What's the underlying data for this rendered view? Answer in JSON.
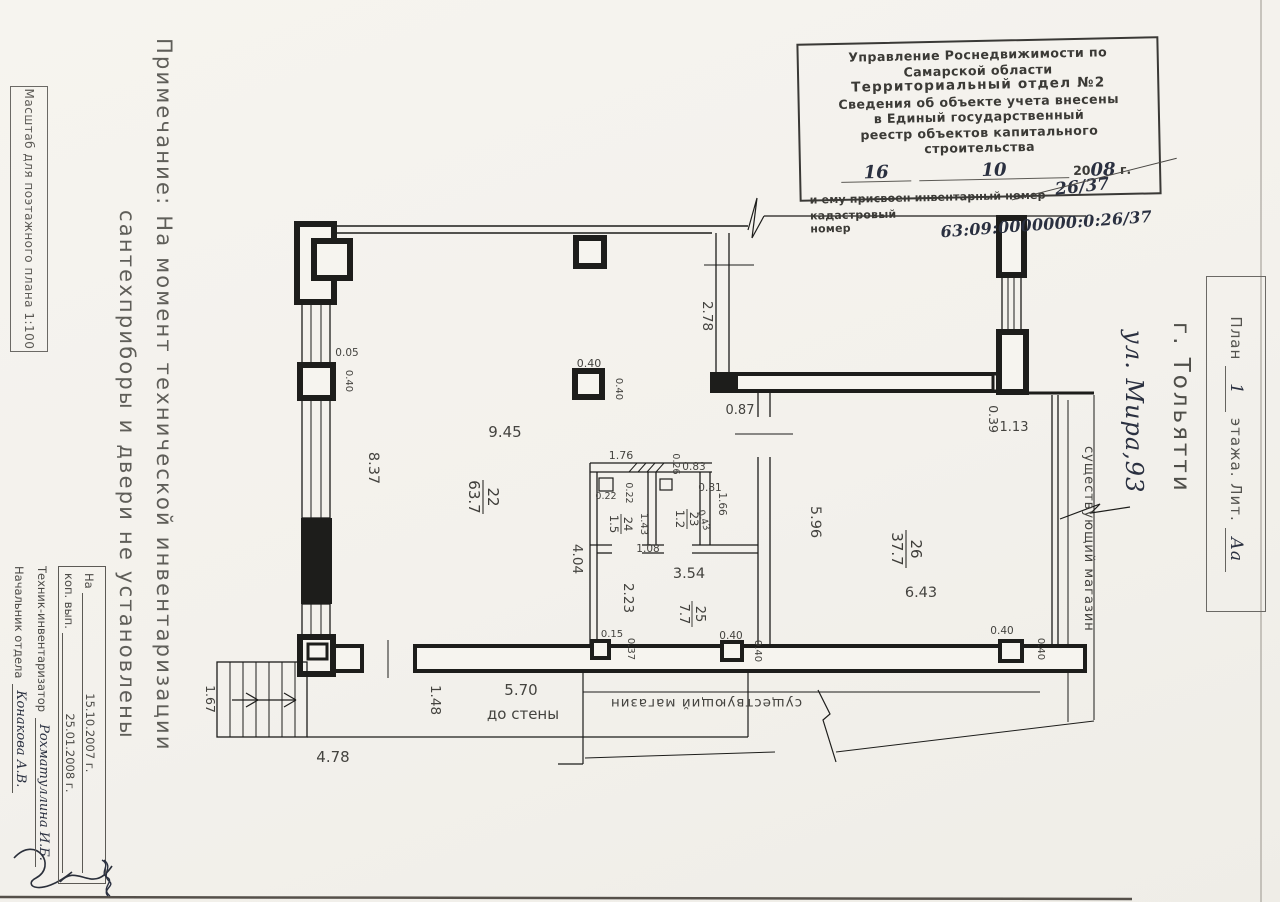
{
  "scale_box": {
    "text": "Масштаб для поэтажного плана 1:100"
  },
  "note": {
    "line1": "Примечание: На момент технической инвентаризации",
    "line2": "сантехприборы и двери не установлены"
  },
  "stamp": {
    "line1": "Управление  Роснедвижимости  по",
    "line2": "Самарской  области",
    "line3": "Территориальный  отдел  №2",
    "line4": "Сведения об объекте учета внесены",
    "line5": "в Единый государственный",
    "line6": "реестр объектов капитального строительства",
    "day": "16",
    "month": "10",
    "year_prefix": "20",
    "year": "08",
    "year_suffix": "г.",
    "inv_label": "и ему присвоен инвентарный номер",
    "inv_value": "26/37",
    "cad_label": "кадастровый номер",
    "cad_value": "63:09:0000000:0:26/37"
  },
  "exec_box": {
    "row1_label": "На",
    "row1_date": "15.10.2007 г.",
    "row2_label": "коп. вып.",
    "row2_date": "25.01.2008 г.",
    "row3_label": "Техник-инвентаризатор",
    "row3_name": "Рохматуллина И.Б.",
    "row4_label": "Начальник отдела",
    "row4_name": "Конакова А.В."
  },
  "side": {
    "plan_box_prefix": "План",
    "plan_box_num": "1",
    "plan_box_mid": "этажа. Лит.",
    "plan_box_lit": "Аа",
    "city": "г. Тольятти",
    "street": "ул. Мира,93"
  },
  "plan": {
    "rooms": [
      {
        "num": "22",
        "area": "63.7"
      },
      {
        "num": "23",
        "area": "1.2"
      },
      {
        "num": "24",
        "area": "1.5"
      },
      {
        "num": "25",
        "area": "7.7"
      },
      {
        "num": "26",
        "area": "37.7"
      }
    ],
    "dims": {
      "d005": "0.05",
      "d015": "0.15",
      "d022": "0.22",
      "d026": "0.26",
      "d037": "0.37",
      "d039": "0.39",
      "d040": "0.40",
      "d043": "0.43",
      "d081": "0.81",
      "d083": "0.83",
      "d087": "0.87",
      "d108": "1.08",
      "d113": "1.13",
      "d143": "1.43",
      "d148": "1.48",
      "d166": "1.66",
      "d167": "1.67",
      "d176": "1.76",
      "d223": "2.23",
      "d278": "2.78",
      "d354": "3.54",
      "d404": "4.04",
      "d478": "4.78",
      "d570": "5.70",
      "d596": "5.96",
      "d643": "6.43",
      "d837": "8.37",
      "d945": "9.45"
    },
    "texts": {
      "existing_shop": "существующий магазин",
      "to_wall": "до стены"
    }
  }
}
